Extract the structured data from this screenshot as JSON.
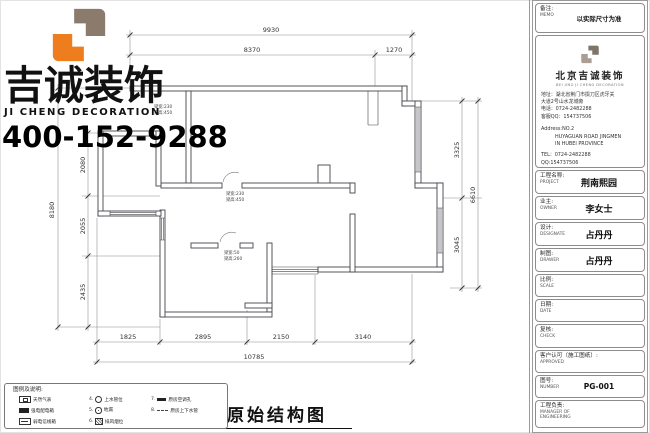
{
  "brand": {
    "name_cn": "吉诚装饰",
    "name_en": "JI CHENG DECORATION",
    "phone": "400-152-9288",
    "logo_orange": "#ed7d1d",
    "logo_brown": "#8a7b6d"
  },
  "drawing": {
    "title": "原始结构图",
    "dims": {
      "top": {
        "overall": "9930",
        "a": "8370",
        "b": "1270"
      },
      "bottom": {
        "overall": "10785",
        "a": "1825",
        "b": "2895",
        "c": "2150",
        "d": "3140"
      },
      "left": {
        "overall": "8180",
        "a": "2080",
        "b": "2055",
        "c": "2435"
      },
      "right": {
        "overall": "6610",
        "a": "3325",
        "b": "3045"
      }
    },
    "beam_notes": {
      "a1": {
        "w": "梁宽:230",
        "h": "梁高:450"
      },
      "a2": {
        "w": "梁宽:230",
        "h": "梁高:450"
      },
      "a3": {
        "w": "梁宽:50",
        "h": "梁高:260"
      }
    }
  },
  "legend": {
    "header": "图例及说明:",
    "col1": [
      {
        "label": "天然气表"
      },
      {
        "label": "强电配电箱"
      },
      {
        "label": "弱电信线箱"
      }
    ],
    "col2": [
      {
        "num": "4.",
        "label": "上水管位"
      },
      {
        "num": "5.",
        "label": "地漏"
      },
      {
        "num": "6.",
        "label": "排风烟位"
      }
    ],
    "col3": [
      {
        "num": "7.",
        "label": "原房空调孔"
      },
      {
        "num": "8.",
        "label": "原房上下水管"
      }
    ]
  },
  "titleblock": {
    "memo": {
      "label_cn": "备注:",
      "label_en": "MEMO",
      "value": "以实际尺寸为准"
    },
    "company": {
      "name_cn": "北京吉诚装饰",
      "name_en": "BEI JING JI CHENG DECORATION",
      "addr1": "地址：湖北省荆门市掇刀区虎牙关",
      "addr2": "大道2号山水龙城旁",
      "tel": "电话：0724-2482288",
      "qq": "客服QQ：154737506",
      "addr_en1": "Address:NO.2",
      "addr_en2": "HUYAGUAN ROAD JINGMEN",
      "addr_en3": "IN HUBEI PROVINCE",
      "tel_en": "TEL：0724-2482288",
      "qq_en": "QQ:154737506"
    },
    "project": {
      "label_cn": "工程名称:",
      "label_en": "PROJECT",
      "value": "荆南熙园"
    },
    "owner": {
      "label_cn": "业主:",
      "label_en": "OWNER",
      "value": "李女士"
    },
    "design": {
      "label_cn": "设计:",
      "label_en": "DESIGNATE",
      "value": "占丹丹"
    },
    "drawer": {
      "label_cn": "制图:",
      "label_en": "DRAWER",
      "value": "占丹丹"
    },
    "scale": {
      "label_cn": "比例:",
      "label_en": "SCALE",
      "value": ""
    },
    "date": {
      "label_cn": "日期:",
      "label_en": "DATE",
      "value": ""
    },
    "check": {
      "label_cn": "复核:",
      "label_en": "CHECK",
      "value": ""
    },
    "approved": {
      "label_cn": "客户认可（施工图纸）:",
      "label_en": "APPROVED",
      "value": ""
    },
    "number": {
      "label_cn": "图号:",
      "label_en": "NUMBER",
      "value": "PG-001"
    },
    "manager": {
      "label_cn": "工程负责:",
      "label_en": "MANAGER OF\nENGINEERING",
      "value": ""
    }
  }
}
